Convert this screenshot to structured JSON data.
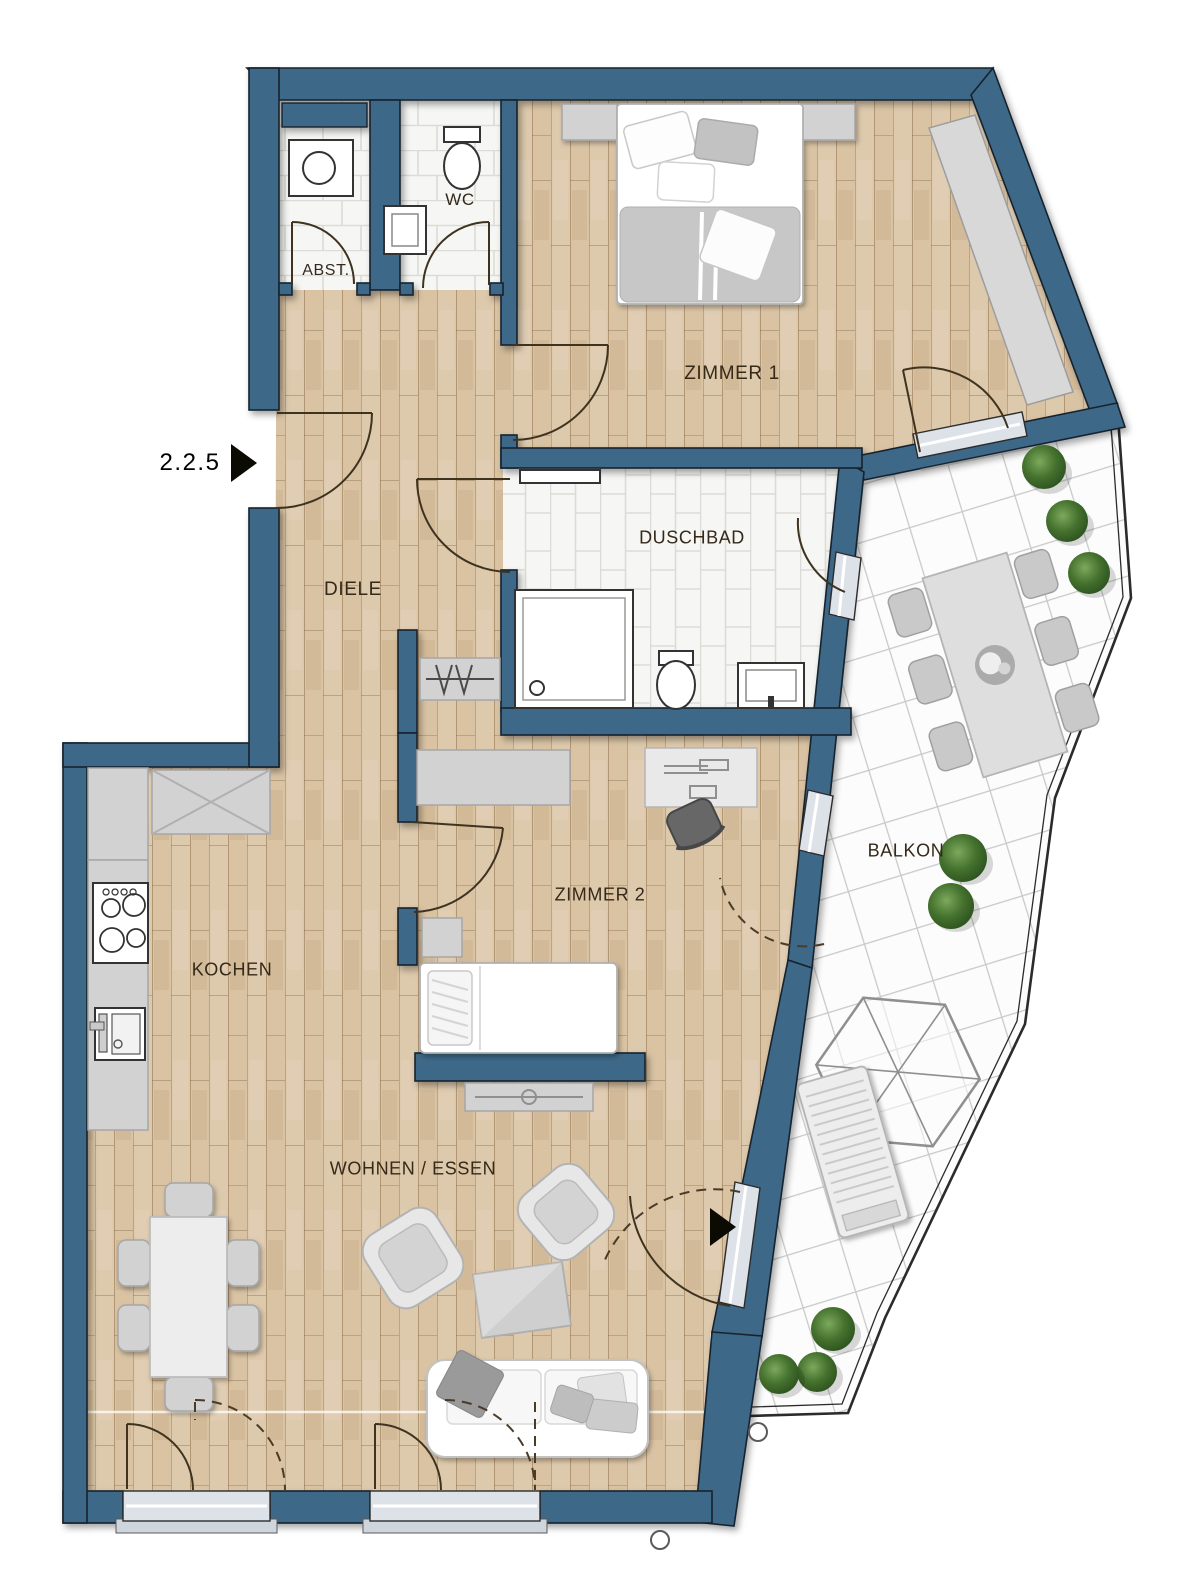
{
  "plan": {
    "unit_label": "2.2.5",
    "room_labels": {
      "abst": "ABST.",
      "wc": "WC",
      "zimmer1": "ZIMMER 1",
      "diele": "DIELE",
      "duschbad": "DUSCHBAD",
      "zimmer2": "ZIMMER 2",
      "balkon": "BALKON",
      "kochen": "KOCHEN",
      "wohnen_essen": "WOHNEN / ESSEN"
    },
    "colors": {
      "wall": "#3e6887",
      "wood_floor": "#d9c3a3",
      "wood_grain": "#b08c61",
      "tile_floor": "#f6f6f4",
      "tile_line": "#dcdcd6",
      "balcony_tile": "#fcfcfc",
      "balcony_line": "#c8c8c8",
      "furniture_gray": "#d2d2d2",
      "window_glaze": "#dde2e9",
      "plant_green": "#46732f",
      "plant_dark": "#2e5420"
    }
  }
}
